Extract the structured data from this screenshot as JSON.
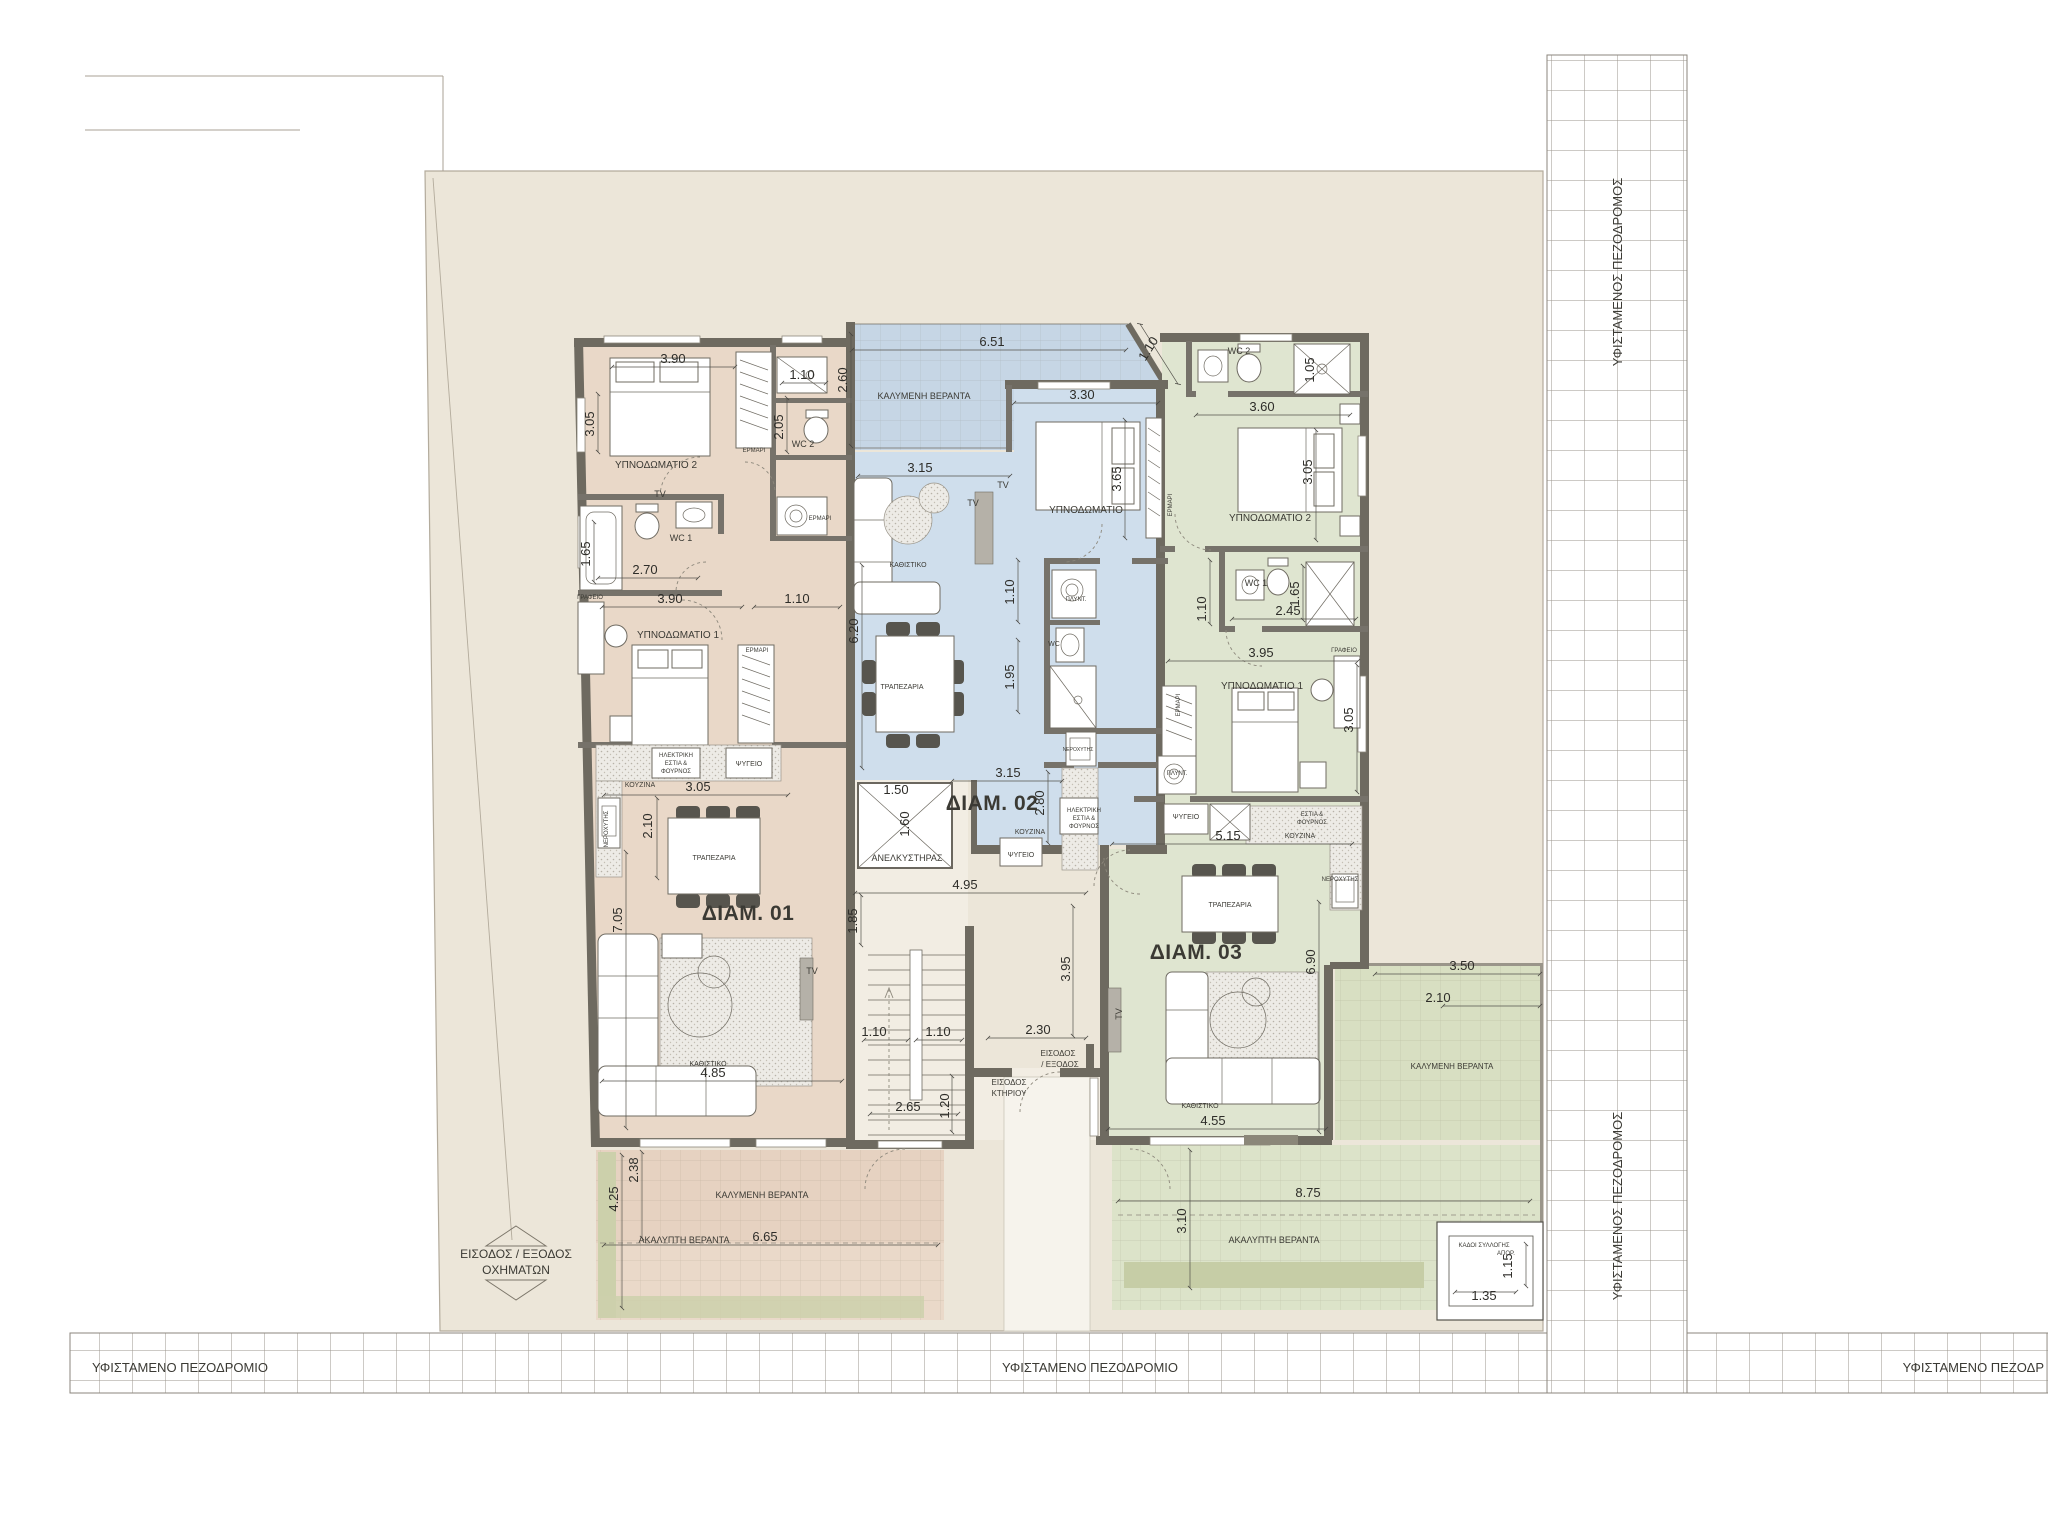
{
  "title": "apartment-building-floor-plan",
  "colors": {
    "apartment_01_beige": "#e9d8c8",
    "apartment_02_blue": "#cfdeec",
    "apartment_03_green": "#dfe5d0",
    "plot_cream": "#ece6d9",
    "veranda_beige": "#e6d2c1",
    "veranda_blue": "#c6d6e5",
    "veranda_green": "#d8dfc2",
    "wall_gray": "#6e6a60",
    "planter_green": "#c9cfaa"
  },
  "sidewalk": {
    "bottom_left": "ΥΦΙΣΤΑΜΕΝΟ ΠΕΖΟΔΡΟΜΙΟ",
    "bottom_center": "ΥΦΙΣΤΑΜΕΝΟ ΠΕΖΟΔΡΟΜΙΟ",
    "bottom_right": "ΥΦΙΣΤΑΜΕΝΟ ΠΕΖΟΔΡ",
    "right_top": "ΥΦΙΣΤΑΜΕΝΟΣ ΠΕΖΟΔΡΟΜΟΣ",
    "right_bottom": "ΥΦΙΣΤΑΜΕΝΟΣ ΠΕΖΟΔΡΟΜΟΣ"
  },
  "site": {
    "vehicle_line1": "ΕΙΣΟΔΟΣ / ΕΞΟΔΟΣ",
    "vehicle_line2": "ΟΧΗΜΑΤΩΝ"
  },
  "apartments": [
    {
      "id": "01",
      "label": "ΔΙΑΜ. 01"
    },
    {
      "id": "02",
      "label": "ΔΙΑΜ. 02"
    },
    {
      "id": "03",
      "label": "ΔΙΑΜ. 03"
    }
  ],
  "rooms": [
    {
      "t": "ΥΠΝΟΔΩΜΑΤΙΟ 2",
      "x": 656,
      "y": 468,
      "s": 10
    },
    {
      "t": "TV",
      "x": 660,
      "y": 497,
      "s": 9
    },
    {
      "t": "WC 2",
      "x": 803,
      "y": 447,
      "s": 9
    },
    {
      "t": "ΕΡΜΑΡΙ",
      "x": 754,
      "y": 452,
      "s": 6
    },
    {
      "t": "ΕΡΜΑΡΙ",
      "x": 820,
      "y": 520,
      "s": 6
    },
    {
      "t": "WC 1",
      "x": 681,
      "y": 541,
      "s": 9
    },
    {
      "t": "ΓΡΑΦΕΙΟ",
      "x": 590,
      "y": 599,
      "s": 6
    },
    {
      "t": "ΥΠΝΟΔΩΜΑΤΙΟ 1",
      "x": 678,
      "y": 638,
      "s": 10
    },
    {
      "t": "ΕΡΜΑΡΙ",
      "x": 757,
      "y": 652,
      "s": 6
    },
    {
      "t": "ΗΛΕΚΤΡΙΚΗ",
      "x": 676,
      "y": 757,
      "s": 6
    },
    {
      "t": "ΕΣΤΙΑ &",
      "x": 676,
      "y": 765,
      "s": 6
    },
    {
      "t": "ΦΟΥΡΝΟΣ",
      "x": 676,
      "y": 773,
      "s": 6
    },
    {
      "t": "ΨΥΓΕΙΟ",
      "x": 749,
      "y": 766,
      "s": 7
    },
    {
      "t": "ΚΟΥΖΙΝΑ",
      "x": 640,
      "y": 787,
      "s": 7
    },
    {
      "t": "ΝΕΡΟΧΥΤΗΣ",
      "x": 608,
      "y": 829,
      "s": 6,
      "r": -90
    },
    {
      "t": "ΤΡΑΠΕΖΑΡΙΑ",
      "x": 714,
      "y": 860,
      "s": 7
    },
    {
      "t": "ΔΙΑΜ. 01",
      "x": 748,
      "y": 920,
      "s": 21,
      "b": 1
    },
    {
      "t": "ΚΑΘΙΣΤΙΚΟ",
      "x": 708,
      "y": 1066,
      "s": 7
    },
    {
      "t": "TV",
      "x": 812,
      "y": 974,
      "s": 9
    },
    {
      "t": "ΚΑΛΥΜΕΝΗ ΒΕΡΑΝΤΑ",
      "x": 762,
      "y": 1198,
      "s": 9
    },
    {
      "t": "ΑΚΑΛΥΠΤΗ ΒΕΡΑΝΤΑ",
      "x": 684,
      "y": 1243,
      "s": 9
    },
    {
      "t": "ΚΑΛΥΜΕΝΗ ΒΕΡΑΝΤΑ",
      "x": 924,
      "y": 399,
      "s": 9
    },
    {
      "t": "ΚΑΘΙΣΤΙΚΟ",
      "x": 908,
      "y": 567,
      "s": 7
    },
    {
      "t": "ΤΡΑΠΕΖΑΡΙΑ",
      "x": 902,
      "y": 689,
      "s": 7
    },
    {
      "t": "TV",
      "x": 1003,
      "y": 488,
      "s": 9
    },
    {
      "t": "TV",
      "x": 973,
      "y": 506,
      "s": 9
    },
    {
      "t": "ΥΠΝΟΔΩΜΑΤΙΟ",
      "x": 1086,
      "y": 513,
      "s": 10
    },
    {
      "t": "ΕΡΜΑΡΙ",
      "x": 1172,
      "y": 505,
      "s": 6,
      "r": -90
    },
    {
      "t": "ΠΛΥΝΤ.",
      "x": 1076,
      "y": 601,
      "s": 6
    },
    {
      "t": "WC",
      "x": 1054,
      "y": 646,
      "s": 7
    },
    {
      "t": "ΝΕΡΟΧΥΤΗΣ",
      "x": 1078,
      "y": 751,
      "s": 5
    },
    {
      "t": "ΔΙΑΜ. 02",
      "x": 992,
      "y": 810,
      "s": 21,
      "b": 1
    },
    {
      "t": "ΚΟΥΖΙΝΑ",
      "x": 1030,
      "y": 834,
      "s": 7
    },
    {
      "t": "ΨΥΓΕΙΟ",
      "x": 1021,
      "y": 857,
      "s": 7
    },
    {
      "t": "ΗΛΕΚΤΡΙΚΗ",
      "x": 1084,
      "y": 812,
      "s": 6
    },
    {
      "t": "ΕΣΤΙΑ &",
      "x": 1084,
      "y": 820,
      "s": 6
    },
    {
      "t": "ΦΟΥΡΝΟΣ",
      "x": 1084,
      "y": 828,
      "s": 6
    },
    {
      "t": "ΑΝΕΛΚΥΣΤΗΡΑΣ",
      "x": 907,
      "y": 861,
      "s": 9
    },
    {
      "t": "WC 2",
      "x": 1239,
      "y": 354,
      "s": 9
    },
    {
      "t": "ΥΠΝΟΔΩΜΑΤΙΟ 2",
      "x": 1270,
      "y": 521,
      "s": 10
    },
    {
      "t": "WC 1",
      "x": 1256,
      "y": 586,
      "s": 9
    },
    {
      "t": "ΓΡΑΦΕΙΟ",
      "x": 1344,
      "y": 652,
      "s": 6
    },
    {
      "t": "ΥΠΝΟΔΩΜΑΤΙΟ 1",
      "x": 1262,
      "y": 689,
      "s": 10
    },
    {
      "t": "ΕΡΜΑΡΙ",
      "x": 1180,
      "y": 705,
      "s": 6,
      "r": -90
    },
    {
      "t": "ΠΛΥΝΤ.",
      "x": 1177,
      "y": 775,
      "s": 6
    },
    {
      "t": "ΨΥΓΕΙΟ",
      "x": 1186,
      "y": 819,
      "s": 7
    },
    {
      "t": "ΚΟΥΖΙΝΑ",
      "x": 1300,
      "y": 838,
      "s": 7
    },
    {
      "t": "ΕΣΤΙΑ &",
      "x": 1312,
      "y": 816,
      "s": 6
    },
    {
      "t": "ΦΟΥΡΝΟΣ",
      "x": 1312,
      "y": 824,
      "s": 6
    },
    {
      "t": "ΝΕΡΟΧΥΤΗΣ",
      "x": 1340,
      "y": 881,
      "s": 6
    },
    {
      "t": "ΤΡΑΠΕΖΑΡΙΑ",
      "x": 1230,
      "y": 907,
      "s": 7
    },
    {
      "t": "ΔΙΑΜ. 03",
      "x": 1196,
      "y": 959,
      "s": 21,
      "b": 1
    },
    {
      "t": "ΚΑΘΙΣΤΙΚΟ",
      "x": 1200,
      "y": 1108,
      "s": 7
    },
    {
      "t": "TV",
      "x": 1122,
      "y": 1014,
      "s": 9,
      "r": -90
    },
    {
      "t": "ΚΑΛΥΜΕΝΗ ΒΕΡΑΝΤΑ",
      "x": 1452,
      "y": 1069,
      "s": 8
    },
    {
      "t": "ΑΚΑΛΥΠΤΗ ΒΕΡΑΝΤΑ",
      "x": 1274,
      "y": 1243,
      "s": 9
    },
    {
      "t": "ΕΙΣΟΔΟΣ",
      "x": 1058,
      "y": 1056,
      "s": 8
    },
    {
      "t": "/ ΕΞΟΔΟΣ",
      "x": 1060,
      "y": 1067,
      "s": 8
    },
    {
      "t": "ΕΙΣΟΔΟΣ",
      "x": 1009,
      "y": 1085,
      "s": 8
    },
    {
      "t": "ΚΤΗΡΙΟΥ",
      "x": 1009,
      "y": 1096,
      "s": 8
    },
    {
      "t": "ΚΑΔΟΙ ΣΥΛΛΟΓΗΣ",
      "x": 1484,
      "y": 1247,
      "s": 6
    },
    {
      "t": "ΑΠΟΡ.",
      "x": 1506,
      "y": 1255,
      "s": 6
    }
  ],
  "dims": [
    {
      "t": "3.90",
      "x": 673,
      "y": 363
    },
    {
      "t": "3.05",
      "x": 594,
      "y": 424,
      "r": -90
    },
    {
      "t": "1.10",
      "x": 802,
      "y": 379
    },
    {
      "t": "2.05",
      "x": 783,
      "y": 427,
      "r": -90
    },
    {
      "t": "2.70",
      "x": 645,
      "y": 574
    },
    {
      "t": "3.90",
      "x": 670,
      "y": 603
    },
    {
      "t": "1.10",
      "x": 797,
      "y": 603
    },
    {
      "t": "1.65",
      "x": 590,
      "y": 554,
      "r": -90
    },
    {
      "t": "3.05",
      "x": 698,
      "y": 791
    },
    {
      "t": "2.10",
      "x": 652,
      "y": 826,
      "r": -90
    },
    {
      "t": "7.05",
      "x": 622,
      "y": 920,
      "r": -90
    },
    {
      "t": "1.85",
      "x": 857,
      "y": 921,
      "r": -90
    },
    {
      "t": "4.85",
      "x": 713,
      "y": 1077
    },
    {
      "t": "6.65",
      "x": 765,
      "y": 1241
    },
    {
      "t": "2.38",
      "x": 638,
      "y": 1170,
      "r": -90
    },
    {
      "t": "4.25",
      "x": 618,
      "y": 1199,
      "r": -90
    },
    {
      "t": "6.51",
      "x": 992,
      "y": 346
    },
    {
      "t": "2.60",
      "x": 847,
      "y": 380,
      "r": -90
    },
    {
      "t": "1.10",
      "x": 1152,
      "y": 351,
      "r": -58
    },
    {
      "t": "3.30",
      "x": 1082,
      "y": 399
    },
    {
      "t": "3.15",
      "x": 920,
      "y": 472
    },
    {
      "t": "3.65",
      "x": 1121,
      "y": 479,
      "r": -90
    },
    {
      "t": "6.20",
      "x": 858,
      "y": 631,
      "r": -90
    },
    {
      "t": "1.10",
      "x": 1014,
      "y": 592,
      "r": -90
    },
    {
      "t": "1.95",
      "x": 1014,
      "y": 677,
      "r": -90
    },
    {
      "t": "3.15",
      "x": 1008,
      "y": 777
    },
    {
      "t": "2.80",
      "x": 1044,
      "y": 803,
      "r": -90
    },
    {
      "t": "1.50",
      "x": 896,
      "y": 794
    },
    {
      "t": "1.60",
      "x": 909,
      "y": 824,
      "r": -90
    },
    {
      "t": "1.05",
      "x": 1314,
      "y": 370,
      "r": -90
    },
    {
      "t": "3.60",
      "x": 1262,
      "y": 411
    },
    {
      "t": "3.05",
      "x": 1312,
      "y": 472,
      "r": -90
    },
    {
      "t": "1.10",
      "x": 1206,
      "y": 609,
      "r": -90
    },
    {
      "t": "2.45",
      "x": 1288,
      "y": 615
    },
    {
      "t": "1.65",
      "x": 1299,
      "y": 594,
      "r": -90
    },
    {
      "t": "3.95",
      "x": 1261,
      "y": 657
    },
    {
      "t": "3.05",
      "x": 1353,
      "y": 720,
      "r": -90
    },
    {
      "t": "5.15",
      "x": 1228,
      "y": 840
    },
    {
      "t": "6.90",
      "x": 1315,
      "y": 962,
      "r": -90
    },
    {
      "t": "3.50",
      "x": 1462,
      "y": 970
    },
    {
      "t": "2.10",
      "x": 1438,
      "y": 1002
    },
    {
      "t": "4.55",
      "x": 1213,
      "y": 1125
    },
    {
      "t": "8.75",
      "x": 1308,
      "y": 1197
    },
    {
      "t": "3.10",
      "x": 1186,
      "y": 1221,
      "r": -90
    },
    {
      "t": "1.35",
      "x": 1484,
      "y": 1300
    },
    {
      "t": "1.15",
      "x": 1512,
      "y": 1266,
      "r": -90
    },
    {
      "t": "4.95",
      "x": 965,
      "y": 889
    },
    {
      "t": "1.10",
      "x": 874,
      "y": 1036
    },
    {
      "t": "1.10",
      "x": 938,
      "y": 1036
    },
    {
      "t": "2.65",
      "x": 908,
      "y": 1111
    },
    {
      "t": "1.20",
      "x": 949,
      "y": 1106,
      "r": -90
    },
    {
      "t": "2.30",
      "x": 1038,
      "y": 1034
    },
    {
      "t": "3.95",
      "x": 1070,
      "y": 969,
      "r": -90
    }
  ]
}
